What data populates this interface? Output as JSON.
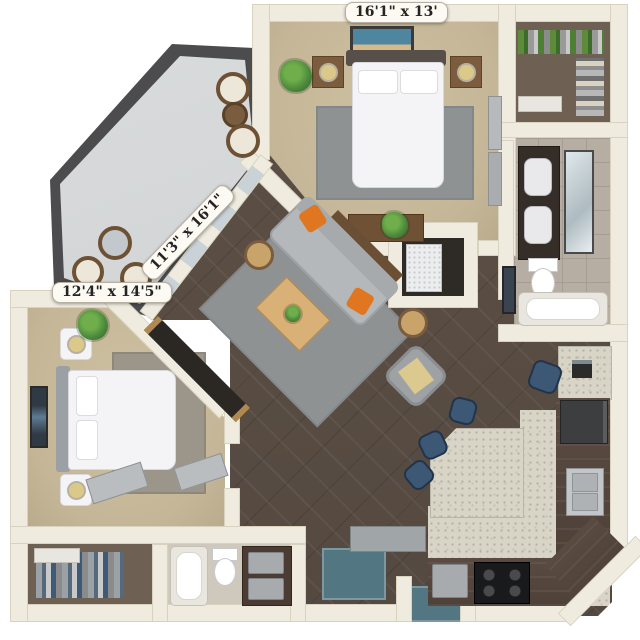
{
  "floor_plan": {
    "title": "3D rendered two-bedroom apartment floor plan",
    "dimension_labels": {
      "bedroom_top": "16'1\" x 13'",
      "living_room": "11'3\" x 16'1\"",
      "bedroom_left": "12'4\" x 14'5\""
    },
    "colors": {
      "wall": "#f0ebdf",
      "carpet": "#c6b89b",
      "wood_floor": "#5c5047",
      "balcony_floor": "#d3d5d6",
      "railing": "#4c4c4e",
      "rug_gray": "#8f9293",
      "accent_orange": "#e0761f",
      "kitchen_cabinet": "#54463d",
      "granite_counter": "#d8d4c6",
      "entry_tile": "#527682",
      "stool_blue": "#3c5875",
      "plant_green": "#4c8a3c"
    }
  }
}
